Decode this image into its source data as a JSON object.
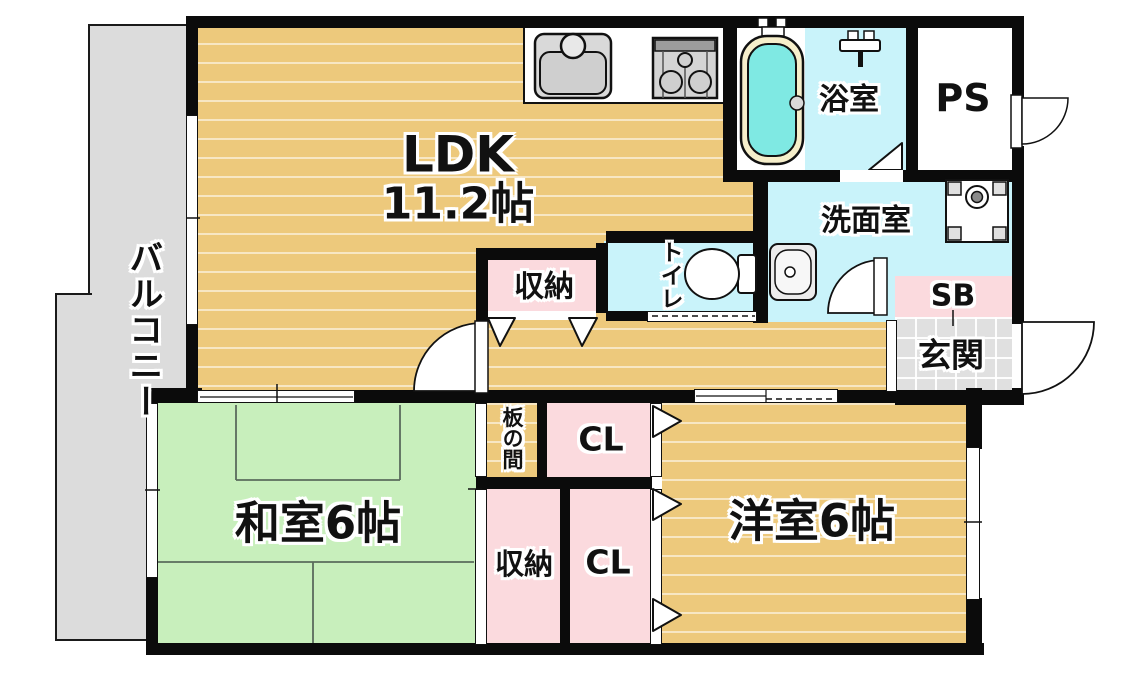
{
  "plan_title": "1LDK+2room apartment floor plan",
  "colors": {
    "wall": "#0b0b0b",
    "wood_floor": "#edc97c",
    "tatami_green": "#c8efbc",
    "wet_area_cyan": "#c9f3fa",
    "tub_water": "#7fe9e3",
    "closet_pink": "#fbdade",
    "balcony_gray": "#dcdcdc",
    "entrance_tile_gray": "#e0e0e0"
  },
  "rooms": {
    "balcony": {
      "label": "バルコニー"
    },
    "ldk": {
      "label": "LDK",
      "size": "11.2帖"
    },
    "bathroom": {
      "label": "浴室"
    },
    "pipe_space": {
      "label": "PS"
    },
    "washroom": {
      "label": "洗面室"
    },
    "toilet": {
      "label": "トイレ"
    },
    "hall_storage": {
      "label": "収納"
    },
    "shoe_box": {
      "label": "SB"
    },
    "entrance": {
      "label": "玄関"
    },
    "itanoma": {
      "label": "板の間"
    },
    "closet_upper": {
      "label": "CL"
    },
    "japanese_room": {
      "label": "和室6帖"
    },
    "japanese_room_storage": {
      "label": "収納"
    },
    "closet_lower": {
      "label": "CL"
    },
    "western_room": {
      "label": "洋室6帖"
    }
  },
  "fixtures": {
    "kitchen_sink": "kitchen sink with faucet",
    "stove": "gas stove 3 burners",
    "bathtub": "bathtub",
    "shower": "shower mixer",
    "washer_pan": "washing machine pan",
    "wash_basin": "wash basin",
    "toilet_bowl": "toilet"
  }
}
